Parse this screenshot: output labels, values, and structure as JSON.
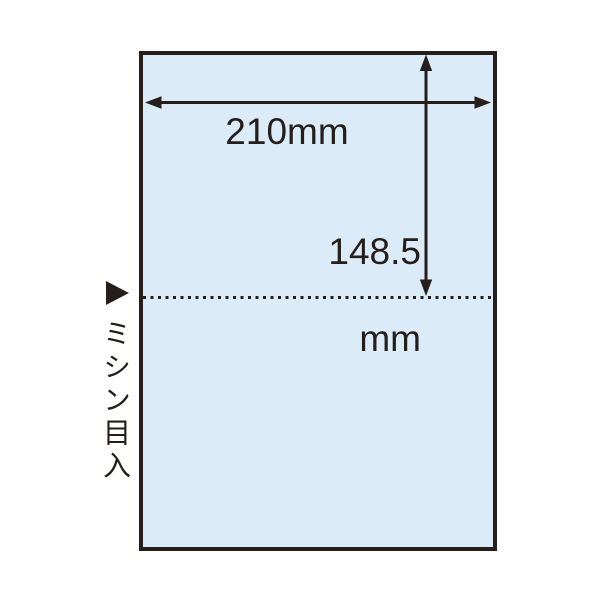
{
  "colors": {
    "ink": "#251e1a",
    "paper_fill": "#dbecf8",
    "background": "#ffffff"
  },
  "diagram": {
    "width_dimension": {
      "label": "210mm"
    },
    "height_dimension": {
      "value": "148.5",
      "unit": "mm"
    },
    "perforation": {
      "label": "ミシン目入"
    }
  }
}
